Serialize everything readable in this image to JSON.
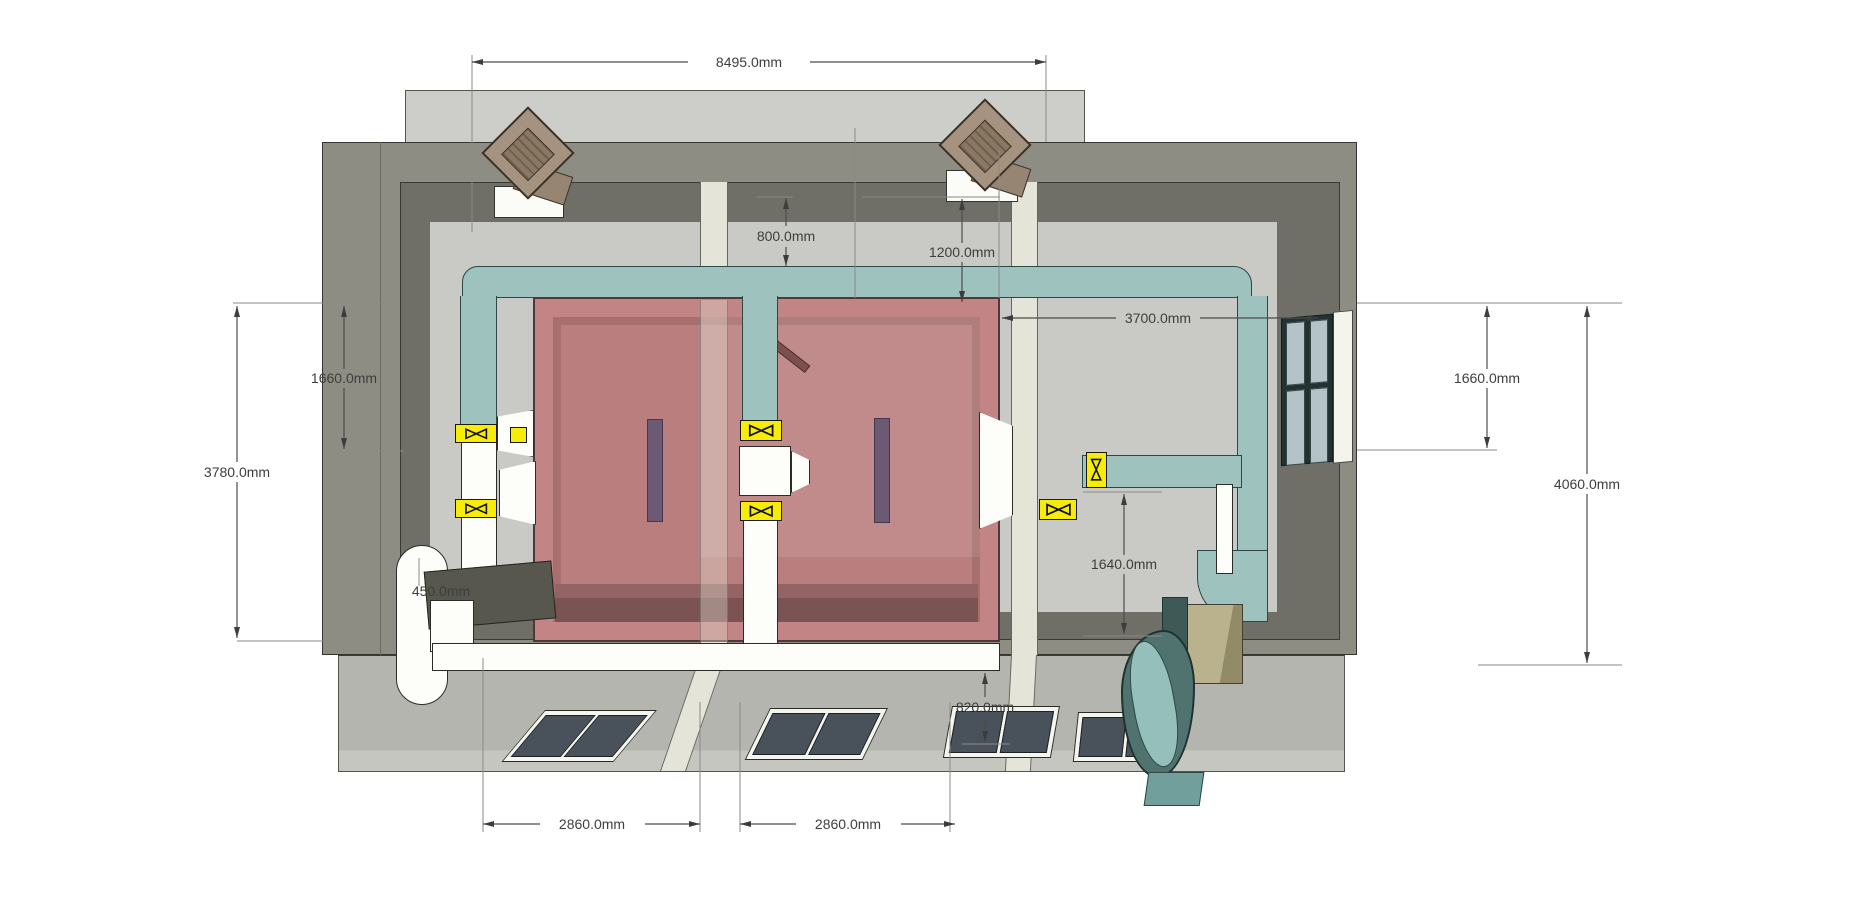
{
  "drawing": {
    "title": "HVAC ductwork plan view with dimensions",
    "units": "mm",
    "dims": [
      {
        "id": "overall-width-top",
        "label": "8495.0mm"
      },
      {
        "id": "duct-offset-800",
        "label": "800.0mm"
      },
      {
        "id": "duct-offset-1200",
        "label": "1200.0mm"
      },
      {
        "id": "room-to-wall-3700",
        "label": "3700.0mm"
      },
      {
        "id": "left-offset-1660",
        "label": "1660.0mm"
      },
      {
        "id": "left-depth-3780",
        "label": "3780.0mm"
      },
      {
        "id": "duct-width-450",
        "label": "450.0mm"
      },
      {
        "id": "right-offset-1660",
        "label": "1660.0mm"
      },
      {
        "id": "right-depth-4060",
        "label": "4060.0mm"
      },
      {
        "id": "branch-drop-1640",
        "label": "1640.0mm"
      },
      {
        "id": "apron-depth-820",
        "label": "820.0mm"
      },
      {
        "id": "bay-width-left-2860",
        "label": "2860.0mm"
      },
      {
        "id": "bay-width-right-2860",
        "label": "2860.0mm"
      }
    ],
    "components": {
      "room": "pink clean-room enclosure",
      "supply_duct": "teal supply duct loop",
      "return_duct": "white return duct run",
      "valve_count": 6,
      "roof_vents": 2,
      "floor_hatches": 4,
      "partitions": 2,
      "window": "right wall window",
      "blower": "teal scroll blower unit"
    },
    "colors": {
      "duct_teal": "#9ec3bf",
      "duct_teal_edge": "#2c4744",
      "valve_yellow": "#f6ec08",
      "room_pink": "#c28484",
      "slot_purple": "#6c5a75",
      "wall_olive": "#8d8d83",
      "wall_inner": "#6f6f67",
      "floor_gray": "#c9c9c5",
      "khaki_box": "#b9b28c",
      "dim_text": "#3e3e3e"
    }
  }
}
